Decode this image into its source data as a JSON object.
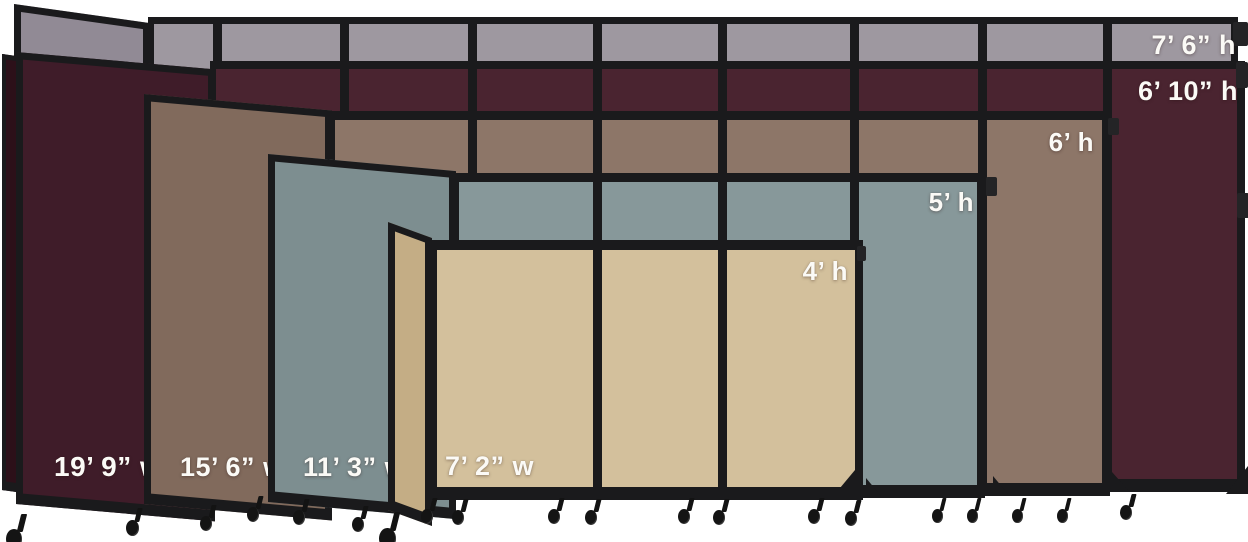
{
  "image_bg": "#ffffff",
  "frame_color": "#1a1a1c",
  "label_color": "#fbfaf6",
  "layers": [
    {
      "id": "7ft6-gray",
      "fabric": "gray",
      "color": "#9e98a0",
      "side_color": "#918a95",
      "height_label": "7’ 6” h",
      "width_label": null,
      "run": {
        "left": 148,
        "top": 17,
        "right": 1238,
        "bottom": 470,
        "bt": 7,
        "bl": 6,
        "br": 7,
        "bb": 0
      },
      "mullions": [
        213,
        340,
        468,
        593,
        718,
        850,
        978,
        1103
      ],
      "side": {
        "left": 14,
        "top": 4,
        "width": 136,
        "height": 90,
        "skew": 8
      },
      "edge": {
        "left": 15,
        "top": 5,
        "width": 26,
        "height": 60,
        "skew": 14,
        "color": "#8b8490"
      },
      "tabs": [
        [
          1233,
          22,
          15,
          24
        ]
      ],
      "feet": [],
      "casters": [],
      "hlabel": {
        "right": 1236,
        "top": 31,
        "size": 27
      },
      "wlabel": null
    },
    {
      "id": "6ft10-cranberry",
      "fabric": "cranberry",
      "color": "#4a2430",
      "side_color": "#3f1c29",
      "height_label": "6’ 10” h",
      "width_label": "19’ 9” w",
      "run": {
        "left": 210,
        "top": 61,
        "right": 1245,
        "bottom": 492,
        "bt": 8,
        "bl": 6,
        "br": 8,
        "bb": 13
      },
      "mullions": [
        340,
        468,
        593,
        718,
        850,
        978,
        1103
      ],
      "side": {
        "left": 16,
        "top": 52,
        "width": 199,
        "height": 452,
        "skew": 5
      },
      "edge": {
        "left": 2,
        "top": 54,
        "width": 16,
        "height": 436,
        "skew": 8,
        "color": "#2c1019"
      },
      "tabs": [
        [
          1236,
          62,
          12,
          26
        ],
        [
          1237,
          193,
          12,
          25
        ]
      ],
      "feet": [
        [
          1226,
          466,
          22,
          28,
          "r"
        ],
        [
          1112,
          472,
          16,
          18,
          "l"
        ]
      ],
      "casters": [
        [
          1120,
          494,
          15
        ],
        [
          126,
          508,
          16
        ],
        [
          6,
          514,
          20
        ]
      ],
      "hlabel": {
        "right": 1238,
        "top": 77,
        "size": 27
      },
      "wlabel": {
        "left": 54,
        "top": 452,
        "size": 28
      }
    },
    {
      "id": "6ft-mocha",
      "fabric": "mocha",
      "color": "#8d7668",
      "side_color": "#816a5c",
      "height_label": "6’ h",
      "width_label": "15’ 6” w",
      "run": {
        "left": 328,
        "top": 111,
        "right": 1110,
        "bottom": 496,
        "bt": 9,
        "bl": 7,
        "br": 8,
        "bb": 13
      },
      "mullions": [
        468,
        593,
        718,
        850,
        978
      ],
      "side": {
        "left": 144,
        "top": 94,
        "width": 188,
        "height": 410,
        "skew": 5
      },
      "edge": null,
      "tabs": [
        [
          1108,
          118,
          11,
          17
        ]
      ],
      "feet": [
        [
          993,
          476,
          15,
          18,
          "l"
        ]
      ],
      "casters": [
        [
          1012,
          498,
          14
        ],
        [
          1057,
          498,
          14
        ],
        [
          200,
          505,
          15
        ],
        [
          247,
          496,
          15
        ]
      ],
      "hlabel": {
        "right": 1094,
        "top": 129,
        "size": 26
      },
      "wlabel": {
        "left": 180,
        "top": 453,
        "size": 27
      }
    },
    {
      "id": "5ft-ocean",
      "fabric": "ocean",
      "color": "#87989a",
      "side_color": "#7d8e90",
      "height_label": "5’ h",
      "width_label": "11’ 3” w",
      "run": {
        "left": 452,
        "top": 173,
        "right": 985,
        "bottom": 498,
        "bt": 9,
        "bl": 7,
        "br": 8,
        "bb": 13
      },
      "mullions": [
        593,
        718,
        850
      ],
      "side": {
        "left": 268,
        "top": 154,
        "width": 188,
        "height": 348,
        "skew": 5.2
      },
      "edge": null,
      "tabs": [
        [
          986,
          177,
          11,
          19
        ]
      ],
      "feet": [
        [
          866,
          478,
          15,
          18,
          "l"
        ]
      ],
      "casters": [
        [
          932,
          498,
          14
        ],
        [
          967,
          498,
          14
        ],
        [
          293,
          499,
          15
        ],
        [
          352,
          506,
          15
        ]
      ],
      "hlabel": {
        "right": 974,
        "top": 189,
        "size": 26
      },
      "wlabel": {
        "left": 303,
        "top": 453,
        "size": 27
      }
    },
    {
      "id": "4ft-sand",
      "fabric": "sand",
      "color": "#d3c09c",
      "side_color": "#c4ad85",
      "height_label": "4’ h",
      "width_label": "7’ 2” w",
      "run": {
        "left": 428,
        "top": 240,
        "right": 863,
        "bottom": 500,
        "bt": 10,
        "bl": 9,
        "br": 8,
        "bb": 13
      },
      "mullions": [
        593,
        718
      ],
      "side": {
        "left": 388,
        "top": 222,
        "width": 44,
        "height": 288,
        "skew": 20
      },
      "edge": null,
      "tabs": [
        [
          857,
          246,
          9,
          15
        ]
      ],
      "feet": [
        [
          840,
          470,
          15,
          18,
          "r"
        ]
      ],
      "casters": [
        [
          421,
          498,
          15
        ],
        [
          452,
          499,
          15
        ],
        [
          548,
          498,
          15
        ],
        [
          585,
          499,
          15
        ],
        [
          678,
          498,
          15
        ],
        [
          713,
          499,
          15
        ],
        [
          808,
          498,
          15
        ],
        [
          845,
          500,
          15
        ],
        [
          379,
          512,
          21
        ]
      ],
      "hlabel": {
        "right": 848,
        "top": 258,
        "size": 26
      },
      "wlabel": {
        "left": 445,
        "top": 452,
        "size": 27
      }
    }
  ]
}
